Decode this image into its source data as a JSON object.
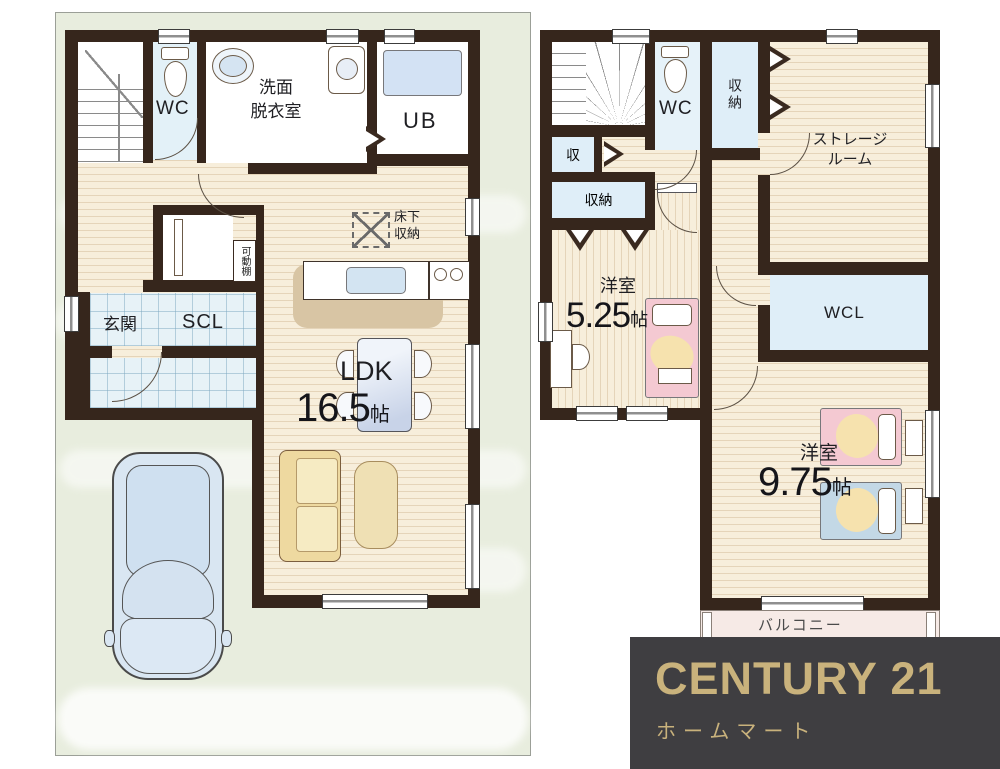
{
  "floor1": {
    "wc": "WC",
    "washroom": [
      "洗面",
      "脱衣室"
    ],
    "ub": "UB",
    "underfloor_storage": [
      "床下",
      "収納"
    ],
    "movable_shelf": "可動棚",
    "entrance": "玄関",
    "scl": "SCL",
    "ldk_label": "LDK",
    "ldk_size": "16.5",
    "ldk_unit": "帖"
  },
  "floor2": {
    "wc": "WC",
    "closet_north": "収納",
    "storage_room": [
      "ストレージ",
      "ルーム"
    ],
    "closet_small": "収",
    "closet_hall": "収納",
    "room_small_label": "洋室",
    "room_small_size": "5.25",
    "room_small_unit": "帖",
    "wcl": "WCL",
    "room_large_label": "洋室",
    "room_large_size": "9.75",
    "room_large_unit": "帖",
    "balcony": "バルコニー"
  },
  "logo": {
    "brand": "CENTURY 21",
    "company": "ホームマート"
  },
  "colors": {
    "wall": "#36261c",
    "wood_floor": "#f7eedb",
    "tile_floor": "#e7f2f7",
    "closet_blue": "#dfeef8",
    "site_green": "#e8edde",
    "balcony_pink": "#f6eae6",
    "logo_bg": "#3f3e41",
    "logo_gold": "#c9b27c"
  }
}
